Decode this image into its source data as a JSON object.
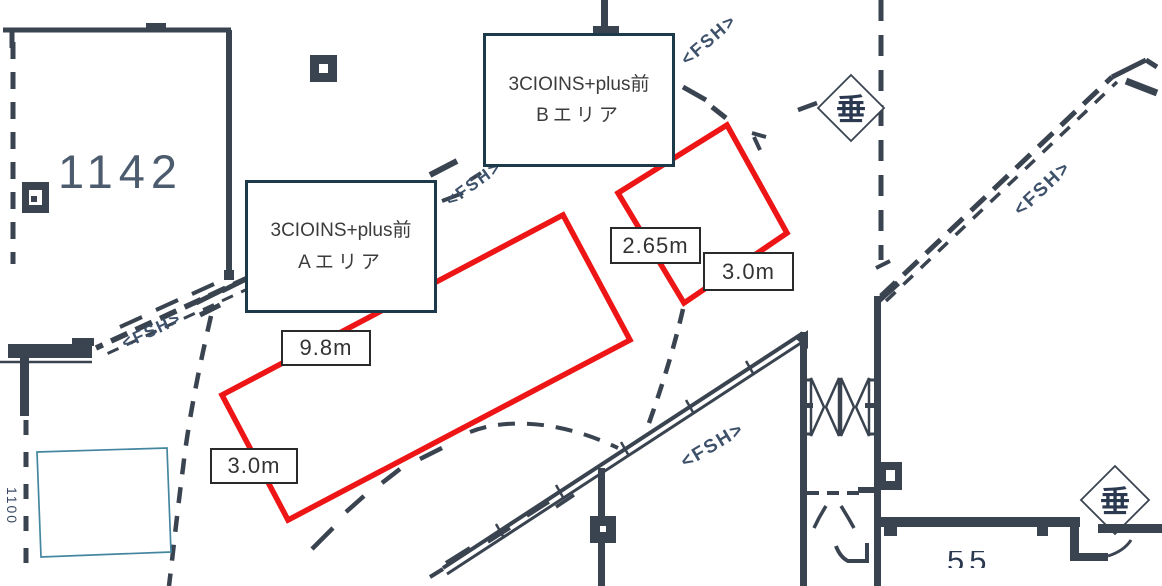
{
  "plan_title": "tenant floor plan with event space annotations",
  "areas": {
    "area_a": {
      "line1": "3CIOINS+plus前",
      "line2": "Aエリア",
      "length_label": "9.8m",
      "width_label": "3.0m"
    },
    "area_b": {
      "line1": "3CIOINS+plus前",
      "line2": "Bエリア",
      "length_label": "2.65m",
      "width_label": "3.0m"
    }
  },
  "rooms": {
    "room_1142": "1142",
    "room_bottom_partial": "55",
    "room_left_rotated": "1100"
  },
  "symbols": {
    "fsh": "<FSH>",
    "hanging_wall": "垂"
  },
  "colors": {
    "highlight_red": "#ed1515",
    "plan_line": "#3a4350",
    "label_border": "#1d3a4a",
    "room_number_blue": "#4c5b6e",
    "fsh_blue": "#3e516b",
    "outline_blue": "#4486a0"
  }
}
